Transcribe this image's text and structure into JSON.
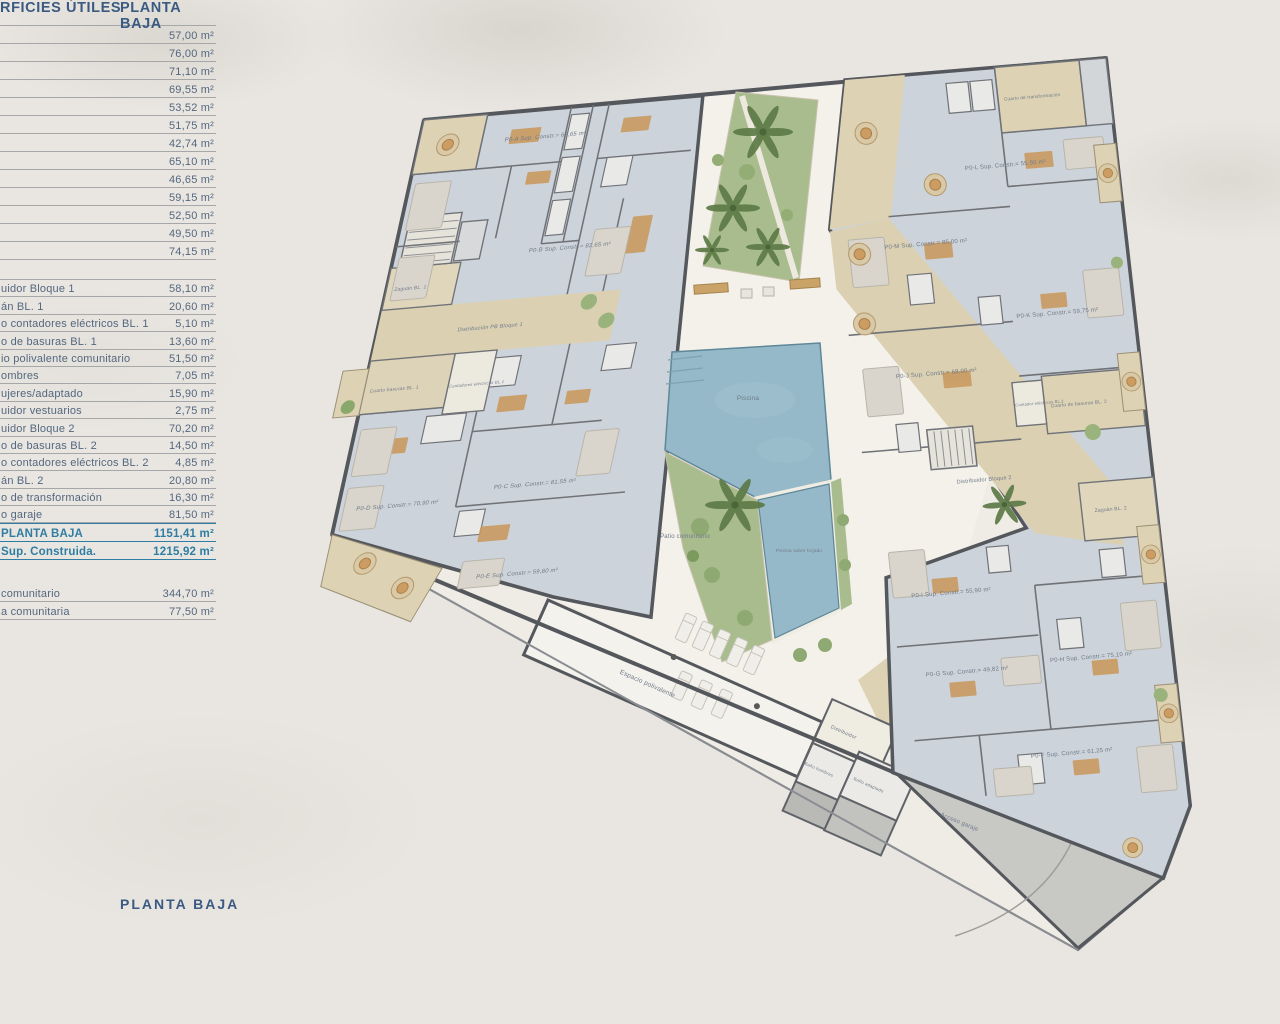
{
  "header": {
    "title_fragment": "RFICIES ÚTILES",
    "column": "PLANTA BAJA"
  },
  "table": {
    "section1": [
      "57,00 m²",
      "76,00 m²",
      "71,10 m²",
      "69,55 m²",
      "53,52 m²",
      "51,75 m²",
      "42,74 m²",
      "65,10 m²",
      "46,65 m²",
      "59,15 m²",
      "52,50 m²",
      "49,50 m²",
      "74,15 m²"
    ],
    "section2": [
      {
        "label": "uidor Bloque 1",
        "value": "58,10 m²"
      },
      {
        "label": "án BL. 1",
        "value": "20,60 m²"
      },
      {
        "label": "o contadores eléctricos BL. 1",
        "value": "5,10 m²"
      },
      {
        "label": "o de basuras BL. 1",
        "value": "13,60 m²"
      },
      {
        "label": "io polivalente comunitario",
        "value": "51,50 m²"
      },
      {
        "label": "ombres",
        "value": "7,05 m²"
      },
      {
        "label": "ujeres/adaptado",
        "value": "15,90 m²"
      },
      {
        "label": "uidor vestuarios",
        "value": "2,75 m²"
      },
      {
        "label": "uidor Bloque 2",
        "value": "70,20 m²"
      },
      {
        "label": "o de basuras BL. 2",
        "value": "14,50 m²"
      },
      {
        "label": "o contadores eléctricos BL. 2",
        "value": "4,85 m²"
      },
      {
        "label": "án BL. 2",
        "value": "20,80 m²"
      },
      {
        "label": "o de transformación",
        "value": "16,30 m²"
      },
      {
        "label": "o garaje",
        "value": "81,50 m²"
      }
    ],
    "totals": [
      {
        "label": "PLANTA BAJA",
        "value": "1151,41 m²"
      },
      {
        "label": "Sup. Construida.",
        "value": "1215,92 m²"
      }
    ],
    "section3": [
      {
        "label": "comunitario",
        "value": "344,70 m²"
      },
      {
        "label": "a comunitaria",
        "value": "77,50 m²"
      }
    ]
  },
  "footer": {
    "plan_title": "PLANTA BAJA"
  },
  "plan": {
    "apartments": {
      "a": "P0-A Sup. Constr.= 67,65 m²",
      "b": "P0-B Sup. Constr.= 82,65 m²",
      "c": "P0-C Sup. Constr.= 81,55 m²",
      "d": "P0-D Sup. Constr.= 70,90 m²",
      "e": "P0-E Sup. Constr.= 59,80 m²",
      "f": "P0-F Sup. Constr.= 61,25 m²",
      "g": "P0-G Sup. Constr.= 49,82 m²",
      "h": "P0-H Sup. Constr.= 75,10 m²",
      "i": "P0-I Sup. Constr.= 55,90 m²",
      "j": "P0-J Sup. Constr.= 68,00 m²",
      "k": "P0-K Sup. Constr.= 59,75 m²",
      "l": "P0-L Sup. Constr.= 55,90 m²",
      "m": "P0-M Sup. Constr.= 85,00 m²"
    },
    "rooms": {
      "zaguan_bl1": "Zaguán BL. 1",
      "distribucion_pb_bloque1": "Distribución PB Bloque 1",
      "cuarto_basuras_bl1": "Cuarto basuras BL. 1",
      "contadores_electricos_bl1": "Contadores eléctricos BL.1",
      "cuarto_basuras_bl2": "Cuarto de basuras BL. 2",
      "contador_electricos_bl2": "Contador eléctricos BL.2",
      "distribuidor_bloque2": "Distribuidor Bloque 2",
      "zaguan_bl2": "Zaguán BL. 2",
      "cuarto_transformacion": "Cuarto de transformación",
      "espacio_polivalente": "Espacio polivalente",
      "distribuidor": "Distribuidor",
      "bano_hombres": "Baño hombres",
      "bano_adaptado": "Baño adaptado",
      "acceso_garaje": "Acceso garaje"
    },
    "exterior": {
      "piscina": "Piscina",
      "piscina_sobre_forjado": "Piscina sobre forjado",
      "patio_comunitario": "Patio comunitario"
    }
  },
  "colors": {
    "table_text": "#54677f",
    "table_header": "#3b5a82",
    "totals_accent": "#2f7da3",
    "wall": "#54575c",
    "apartment_floor": "#cdd3da",
    "corridor_floor": "#dbd0b2",
    "pool": "#95b9c8",
    "garden": "#a9bc8d",
    "garage": "#c8c8c5",
    "paper": "#e9e6e1"
  }
}
